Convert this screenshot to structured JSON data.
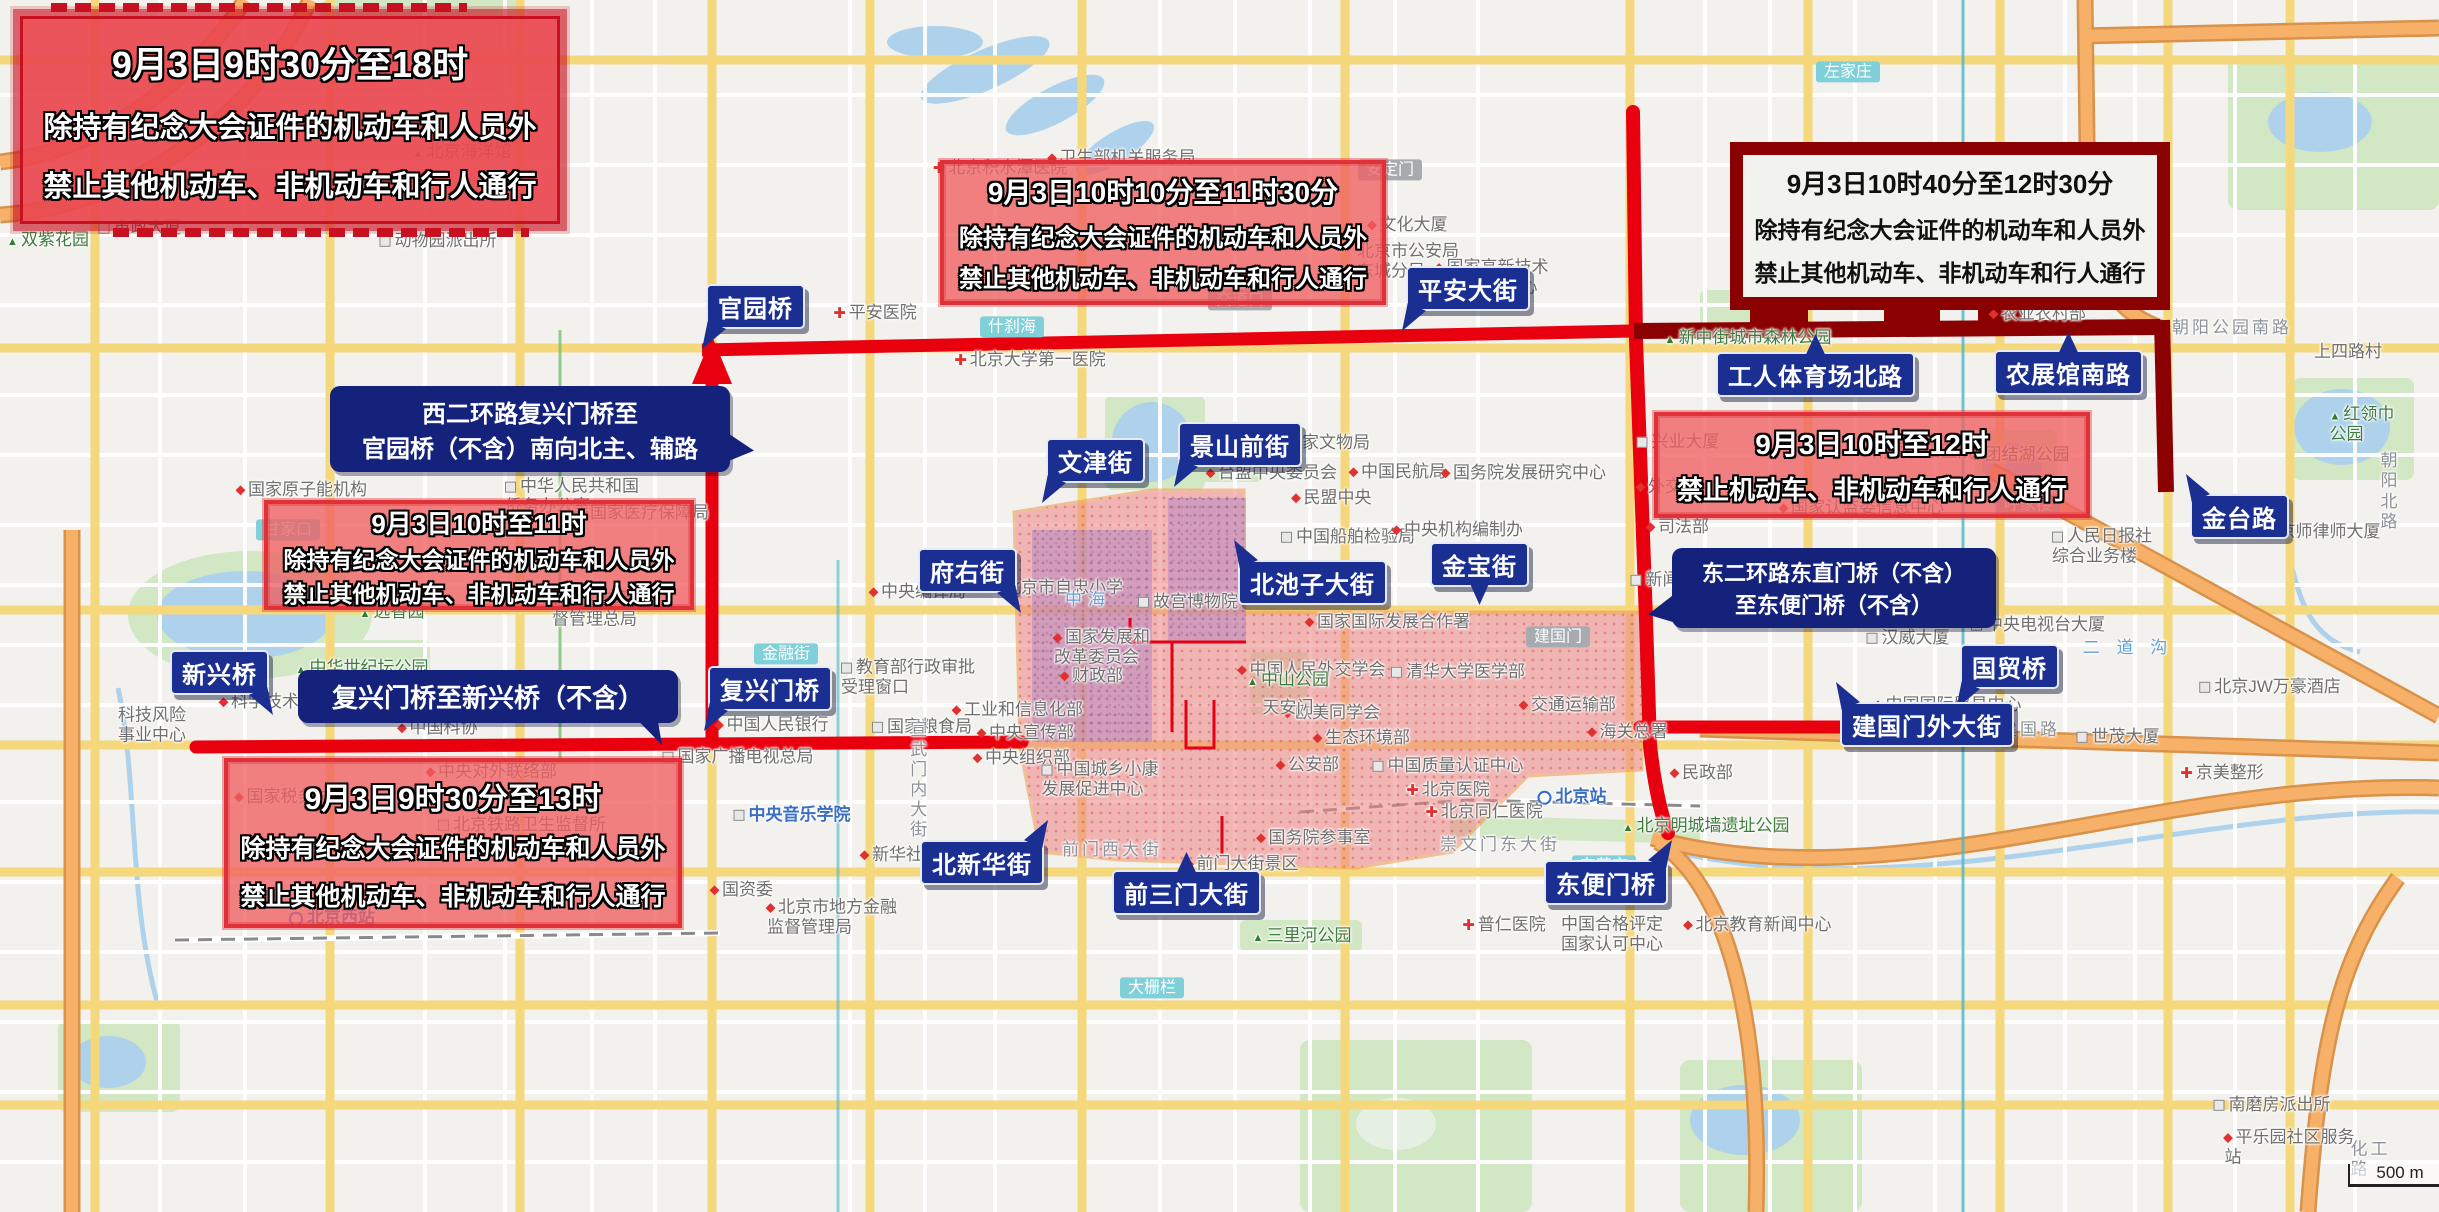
{
  "colors": {
    "restricted_zone_fill": "#ee8585",
    "zone_border": "#f0974f",
    "route_red": "#e8000f",
    "route_maroon": "#8b0000",
    "sign_navy": "#1b2f92",
    "callout_navy": "#14227c",
    "banner_red": "#e8434a",
    "banner_maroon_frame": "#8b0000",
    "water": "#aed2ec",
    "park": "#d2e7c4"
  },
  "scale_bar": {
    "text": "500 m"
  },
  "banners": [
    {
      "style": "tech",
      "x": 20,
      "y": 16,
      "w": 540,
      "h": 208,
      "f1": 36,
      "f": 29,
      "lines": [
        "9月3日9时30分至18时",
        "除持有纪念大会证件的机动车和人员外",
        "禁止其他机动车、非机动车和行人通行"
      ]
    },
    {
      "style": "zone",
      "x": 940,
      "y": 160,
      "w": 446,
      "h": 145,
      "f1": 28,
      "f": 24,
      "lines": [
        "9月3日10时10分至11时30分",
        "除持有纪念大会证件的机动车和人员外",
        "禁止其他机动车、非机动车和行人通行"
      ]
    },
    {
      "style": "maroon",
      "x": 1730,
      "y": 142,
      "w": 440,
      "h": 168,
      "f1": 26,
      "f": 23,
      "lines": [
        "9月3日10时40分至12时30分",
        "除持有纪念大会证件的机动车和人员外",
        "禁止其他机动车、非机动车和行人通行"
      ]
    },
    {
      "style": "zone",
      "x": 1654,
      "y": 412,
      "w": 436,
      "h": 106,
      "f1": 28,
      "f": 26,
      "lines": [
        "9月3日10时至12时",
        "禁止机动车、非机动车和行人通行"
      ]
    },
    {
      "style": "zone",
      "x": 264,
      "y": 500,
      "w": 430,
      "h": 110,
      "f1": 26,
      "f": 23,
      "lines": [
        "9月3日10时至11时",
        "除持有纪念大会证件的机动车和人员外",
        "禁止其他机动车、非机动车和行人通行"
      ]
    },
    {
      "style": "zone",
      "x": 224,
      "y": 758,
      "w": 458,
      "h": 170,
      "f1": 30,
      "f": 25,
      "lines": [
        "9月3日9时30分至13时",
        "除持有纪念大会证件的机动车和人员外",
        "禁止其他机动车、非机动车和行人通行"
      ]
    }
  ],
  "callouts": [
    {
      "x": 330,
      "y": 386,
      "w": 372,
      "f": 24,
      "ptr": "r",
      "lines": [
        "西二环路复兴门桥至",
        "官园桥（不含）南向北主、辅路"
      ]
    },
    {
      "x": 298,
      "y": 670,
      "w": 352,
      "f": 26,
      "ptr": "drc",
      "lines": [
        "复兴门桥至新兴桥（不含）"
      ]
    },
    {
      "x": 1672,
      "y": 548,
      "w": 296,
      "f": 22,
      "ptr": "l",
      "lines": [
        "东二环路东直门桥（不含）",
        "至东便门桥（不含）"
      ]
    }
  ],
  "street_labels": [
    {
      "t": "官园桥",
      "x": 706,
      "y": 284,
      "ptr": "dl"
    },
    {
      "t": "平安大街",
      "x": 1406,
      "y": 266,
      "ptr": "dl"
    },
    {
      "t": "文津街",
      "x": 1046,
      "y": 438,
      "ptr": "dl"
    },
    {
      "t": "景山前街",
      "x": 1178,
      "y": 422,
      "ptr": "dl"
    },
    {
      "t": "府右街",
      "x": 918,
      "y": 548,
      "ptr": "dr"
    },
    {
      "t": "北池子大街",
      "x": 1238,
      "y": 560,
      "ptr": "ul"
    },
    {
      "t": "金宝街",
      "x": 1430,
      "y": 542,
      "ptr": "d"
    },
    {
      "t": "工人体育场北路",
      "x": 1716,
      "y": 352,
      "ptr": "u"
    },
    {
      "t": "农展馆南路",
      "x": 1994,
      "y": 350,
      "ptr": "u"
    },
    {
      "t": "金台路",
      "x": 2190,
      "y": 494,
      "ptr": "ul"
    },
    {
      "t": "国贸桥",
      "x": 1960,
      "y": 644,
      "ptr": "dl"
    },
    {
      "t": "建国门外大街",
      "x": 1840,
      "y": 702,
      "ptr": "ul"
    },
    {
      "t": "东便门桥",
      "x": 1544,
      "y": 860,
      "ptr": "ur"
    },
    {
      "t": "前三门大街",
      "x": 1112,
      "y": 870,
      "ptr": "u"
    },
    {
      "t": "北新华街",
      "x": 920,
      "y": 840,
      "ptr": "ur"
    },
    {
      "t": "复兴门桥",
      "x": 708,
      "y": 666,
      "ptr": "dl"
    },
    {
      "t": "新兴桥",
      "x": 170,
      "y": 650,
      "ptr": "dr"
    }
  ],
  "map_labels": [
    {
      "t": "北京积水潭医院",
      "x": 1000,
      "y": 168,
      "c": "",
      "i": "cross"
    },
    {
      "t": "卫生部机关服务局",
      "x": 1122,
      "y": 158,
      "c": "",
      "i": "dot"
    },
    {
      "t": "安定门",
      "x": 1390,
      "y": 170,
      "c": "box-gray",
      "i": ""
    },
    {
      "t": "交道口",
      "x": 1240,
      "y": 300,
      "c": "box-gray",
      "i": ""
    },
    {
      "t": "文化大厦",
      "x": 1408,
      "y": 225,
      "c": "",
      "i": "dot"
    },
    {
      "t": "北京市公安局\n东城分局",
      "x": 1408,
      "y": 262,
      "c": "",
      "i": ""
    },
    {
      "t": "国家高新技术\n创业服务中心",
      "x": 1492,
      "y": 278,
      "c": "",
      "i": "dot"
    },
    {
      "t": "新中街城市森林公园",
      "x": 1748,
      "y": 338,
      "c": "green",
      "i": "tree"
    },
    {
      "t": "农业农村部",
      "x": 2038,
      "y": 314,
      "c": "",
      "i": "dot"
    },
    {
      "t": "团结湖公园",
      "x": 2020,
      "y": 455,
      "c": "green",
      "i": "tree"
    },
    {
      "t": "附属朝阳医院",
      "x": 1918,
      "y": 452,
      "c": "",
      "i": "dot"
    },
    {
      "t": "兴业大厦",
      "x": 1678,
      "y": 442,
      "c": "",
      "i": "bld"
    },
    {
      "t": "外交部",
      "x": 1668,
      "y": 487,
      "c": "",
      "i": "dot"
    },
    {
      "t": "司法部",
      "x": 1678,
      "y": 527,
      "c": "",
      "i": "dot"
    },
    {
      "t": "国家认监委信息中心",
      "x": 1862,
      "y": 508,
      "c": "",
      "i": "dot"
    },
    {
      "t": "呼家楼",
      "x": 2028,
      "y": 505,
      "c": "box-gray",
      "i": ""
    },
    {
      "t": "人民日报社\n综合业务楼",
      "x": 2102,
      "y": 547,
      "c": "",
      "i": "bld"
    },
    {
      "t": "朝阳公园南路",
      "x": 2232,
      "y": 328,
      "c": "road",
      "i": ""
    },
    {
      "t": "上四路村",
      "x": 2348,
      "y": 352,
      "c": "",
      "i": ""
    },
    {
      "t": "红领巾公园",
      "x": 2366,
      "y": 425,
      "c": "green",
      "i": "tree"
    },
    {
      "t": "朝阳北路",
      "x": 2400,
      "y": 492,
      "c": "road",
      "i": ""
    },
    {
      "t": "二 道 沟",
      "x": 2128,
      "y": 648,
      "c": "blue-water",
      "i": ""
    },
    {
      "t": "京师律师大厦",
      "x": 2322,
      "y": 532,
      "c": "",
      "i": "bld"
    },
    {
      "t": "中央电视台大厦",
      "x": 2038,
      "y": 625,
      "c": "",
      "i": "bld"
    },
    {
      "t": "汉威大厦",
      "x": 1908,
      "y": 638,
      "c": "",
      "i": "bld"
    },
    {
      "t": "中国国际贸易中心",
      "x": 1948,
      "y": 705,
      "c": "",
      "i": "dot"
    },
    {
      "t": "世茂大厦",
      "x": 2118,
      "y": 737,
      "c": "",
      "i": "bld"
    },
    {
      "t": "北京JW万豪酒店",
      "x": 2270,
      "y": 687,
      "c": "",
      "i": "bld"
    },
    {
      "t": "建国路",
      "x": 2030,
      "y": 730,
      "c": "road",
      "i": ""
    },
    {
      "t": "京美整形",
      "x": 2222,
      "y": 773,
      "c": "",
      "i": "cross"
    },
    {
      "t": "北京站",
      "x": 1572,
      "y": 797,
      "c": "blue",
      "i": "metro"
    },
    {
      "t": "崇文门东大街",
      "x": 1500,
      "y": 845,
      "c": "road",
      "i": ""
    },
    {
      "t": "东花市",
      "x": 1604,
      "y": 866,
      "c": "box-teal",
      "i": ""
    },
    {
      "t": "北京明城墙遗址公园",
      "x": 1706,
      "y": 826,
      "c": "green",
      "i": "tree"
    },
    {
      "t": "普仁医院",
      "x": 1504,
      "y": 925,
      "c": "",
      "i": "cross"
    },
    {
      "t": "中国合格评定\n国家认可中心",
      "x": 1612,
      "y": 935,
      "c": "",
      "i": ""
    },
    {
      "t": "北京教育新闻中心",
      "x": 1758,
      "y": 925,
      "c": "",
      "i": "dot"
    },
    {
      "t": "民政部",
      "x": 1702,
      "y": 773,
      "c": "",
      "i": "dot"
    },
    {
      "t": "北京市人民检察院",
      "x": 1746,
      "y": 612,
      "c": "",
      "i": "dot"
    },
    {
      "t": "新闻出版信息中心",
      "x": 1706,
      "y": 580,
      "c": "",
      "i": "bld"
    },
    {
      "t": "建国门",
      "x": 1558,
      "y": 637,
      "c": "box-gray",
      "i": ""
    },
    {
      "t": "国家国际发展合作署",
      "x": 1388,
      "y": 622,
      "c": "",
      "i": "dot"
    },
    {
      "t": "中国人民外交学会",
      "x": 1312,
      "y": 670,
      "c": "",
      "i": "dot"
    },
    {
      "t": "清华大学医学部",
      "x": 1458,
      "y": 672,
      "c": "",
      "i": "bld"
    },
    {
      "t": "交通运输部",
      "x": 1568,
      "y": 705,
      "c": "",
      "i": "dot"
    },
    {
      "t": "欧美同学会",
      "x": 1332,
      "y": 713,
      "c": "",
      "i": "dot"
    },
    {
      "t": "生态环境部",
      "x": 1362,
      "y": 738,
      "c": "",
      "i": "dot"
    },
    {
      "t": "海关总署",
      "x": 1628,
      "y": 732,
      "c": "",
      "i": "dot"
    },
    {
      "t": "公安部",
      "x": 1308,
      "y": 765,
      "c": "",
      "i": "dot"
    },
    {
      "t": "中国质量认证中心",
      "x": 1448,
      "y": 766,
      "c": "",
      "i": "bld"
    },
    {
      "t": "北京医院",
      "x": 1448,
      "y": 790,
      "c": "",
      "i": "cross"
    },
    {
      "t": "北京同仁医院",
      "x": 1484,
      "y": 812,
      "c": "",
      "i": "cross"
    },
    {
      "t": "中央对外联络部",
      "x": 492,
      "y": 772,
      "c": "",
      "i": "dot"
    },
    {
      "t": "国家税务总局",
      "x": 292,
      "y": 797,
      "c": "",
      "i": "dot"
    },
    {
      "t": "北京铁路卫生监督所",
      "x": 522,
      "y": 825,
      "c": "",
      "i": "bld"
    },
    {
      "t": "北京西站",
      "x": 332,
      "y": 918,
      "c": "blue",
      "i": "metro"
    },
    {
      "t": "中央音乐学院",
      "x": 792,
      "y": 815,
      "c": "blue",
      "i": "bld"
    },
    {
      "t": "国资委",
      "x": 742,
      "y": 890,
      "c": "",
      "i": "dot"
    },
    {
      "t": "北京市地方金融\n监督管理局",
      "x": 832,
      "y": 918,
      "c": "",
      "i": "dot"
    },
    {
      "t": "新华社",
      "x": 892,
      "y": 855,
      "c": "",
      "i": "dot"
    },
    {
      "t": "国家粮食局",
      "x": 922,
      "y": 727,
      "c": "",
      "i": "bld"
    },
    {
      "t": "教育部行政审批\n受理窗口",
      "x": 908,
      "y": 678,
      "c": "",
      "i": "bld"
    },
    {
      "t": "中国人民银行",
      "x": 772,
      "y": 725,
      "c": "",
      "i": "dot"
    },
    {
      "t": "国家广播电视总局",
      "x": 738,
      "y": 757,
      "c": "",
      "i": "bld"
    },
    {
      "t": "中央组织部",
      "x": 1022,
      "y": 758,
      "c": "",
      "i": "dot"
    },
    {
      "t": "中央宣传部",
      "x": 1026,
      "y": 733,
      "c": "",
      "i": "dot"
    },
    {
      "t": "工业和信息化部",
      "x": 1018,
      "y": 710,
      "c": "",
      "i": "dot"
    },
    {
      "t": "中国城乡小康\n发展促进中心",
      "x": 1100,
      "y": 780,
      "c": "",
      "i": "bld"
    },
    {
      "t": "中央编译局",
      "x": 918,
      "y": 592,
      "c": "",
      "i": "dot"
    },
    {
      "t": "北京市自忠小学",
      "x": 1058,
      "y": 588,
      "c": "",
      "i": "dot"
    },
    {
      "t": "故宫博物院",
      "x": 1188,
      "y": 602,
      "c": "",
      "i": "bld"
    },
    {
      "t": "中山公园",
      "x": 1288,
      "y": 680,
      "c": "green",
      "i": "tree"
    },
    {
      "t": "天安门",
      "x": 1288,
      "y": 708,
      "c": "",
      "i": ""
    },
    {
      "t": "中海",
      "x": 1088,
      "y": 600,
      "c": "blue-water",
      "i": ""
    },
    {
      "t": "台盟中央委员会",
      "x": 1272,
      "y": 473,
      "c": "",
      "i": "dot"
    },
    {
      "t": "国家文物局",
      "x": 1322,
      "y": 443,
      "c": "",
      "i": "dot"
    },
    {
      "t": "中国民航局",
      "x": 1398,
      "y": 472,
      "c": "",
      "i": "dot"
    },
    {
      "t": "国务院发展研究中心",
      "x": 1524,
      "y": 473,
      "c": "",
      "i": "dot"
    },
    {
      "t": "民盟中央",
      "x": 1332,
      "y": 498,
      "c": "",
      "i": "dot"
    },
    {
      "t": "中国船舶检验局",
      "x": 1348,
      "y": 537,
      "c": "",
      "i": "bld"
    },
    {
      "t": "中央机构编制办",
      "x": 1458,
      "y": 530,
      "c": "",
      "i": "dot"
    },
    {
      "t": "中华人民共和国\n侨务办公室",
      "x": 572,
      "y": 497,
      "c": "",
      "i": "bld"
    },
    {
      "t": "国家医疗保障局",
      "x": 644,
      "y": 513,
      "c": "",
      "i": "dot"
    },
    {
      "t": "甘家口",
      "x": 288,
      "y": 530,
      "c": "box-teal",
      "i": ""
    },
    {
      "t": "国家原子能机构",
      "x": 302,
      "y": 490,
      "c": "",
      "i": "dot"
    },
    {
      "t": "远香园",
      "x": 392,
      "y": 612,
      "c": "green",
      "i": "tree"
    },
    {
      "t": "国家市场监\n督管理总局",
      "x": 600,
      "y": 610,
      "c": "",
      "i": "dot"
    },
    {
      "t": "国家发展和\n改革委员会",
      "x": 1102,
      "y": 648,
      "c": "",
      "i": "dot"
    },
    {
      "t": "财政部",
      "x": 1092,
      "y": 676,
      "c": "",
      "i": "dot"
    },
    {
      "t": "中国科协",
      "x": 438,
      "y": 728,
      "c": "",
      "i": "dot"
    },
    {
      "t": "科学技术部",
      "x": 268,
      "y": 702,
      "c": "",
      "i": "dot"
    },
    {
      "t": "中华世纪坛公园",
      "x": 362,
      "y": 668,
      "c": "green",
      "i": "tree"
    },
    {
      "t": "科技风险\n事业中心",
      "x": 152,
      "y": 726,
      "c": "",
      "i": ""
    },
    {
      "t": "南磨房派出所",
      "x": 2272,
      "y": 1105,
      "c": "",
      "i": "bld"
    },
    {
      "t": "平乐园社区服务站",
      "x": 2296,
      "y": 1148,
      "c": "",
      "i": "dot"
    },
    {
      "t": "化工路",
      "x": 2380,
      "y": 1160,
      "c": "road",
      "i": ""
    },
    {
      "t": "双紫花园",
      "x": 48,
      "y": 240,
      "c": "green",
      "i": "tree"
    },
    {
      "t": "动物园派出所",
      "x": 438,
      "y": 241,
      "c": "",
      "i": "bld"
    },
    {
      "t": "市政大厦",
      "x": 140,
      "y": 228,
      "c": "",
      "i": "bld"
    },
    {
      "t": "北京海洋馆",
      "x": 462,
      "y": 152,
      "c": "green",
      "i": "tree"
    },
    {
      "t": "什刹海",
      "x": 1012,
      "y": 327,
      "c": "box-teal",
      "i": ""
    },
    {
      "t": "金融街",
      "x": 786,
      "y": 654,
      "c": "box-teal",
      "i": ""
    },
    {
      "t": "大栅栏",
      "x": 1152,
      "y": 988,
      "c": "box-teal",
      "i": ""
    },
    {
      "t": "左家庄",
      "x": 1848,
      "y": 72,
      "c": "box-teal",
      "i": ""
    },
    {
      "t": "三里河公园",
      "x": 1302,
      "y": 936,
      "c": "green",
      "i": "tree"
    },
    {
      "t": "前门大街景区",
      "x": 1242,
      "y": 864,
      "c": "",
      "i": "dot"
    },
    {
      "t": "前门西大街",
      "x": 1112,
      "y": 850,
      "c": "road",
      "i": ""
    },
    {
      "t": "国务院参事室",
      "x": 1314,
      "y": 838,
      "c": "",
      "i": "dot"
    },
    {
      "t": "宣武门内大街",
      "x": 916,
      "y": 780,
      "c": "road-v",
      "i": ""
    },
    {
      "t": "北京大学第一医院",
      "x": 1030,
      "y": 360,
      "c": "",
      "i": "cross"
    },
    {
      "t": "平安医院",
      "x": 875,
      "y": 313,
      "c": "",
      "i": "cross"
    }
  ]
}
